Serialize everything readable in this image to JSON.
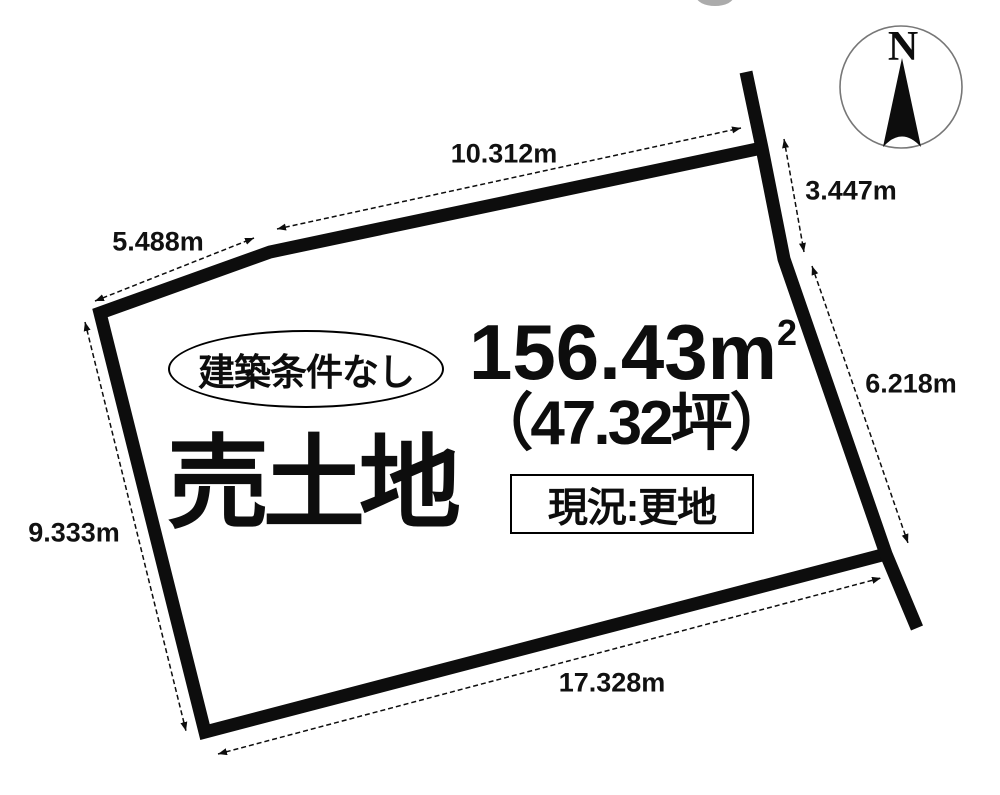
{
  "diagram": {
    "title": "売土地",
    "condition_badge": "建築条件なし",
    "area_m2": "156.43m",
    "area_m2_sup": "2",
    "area_tsubo": "（47.32坪）",
    "status_label": "現況:更地",
    "compass_north": "N"
  },
  "dimensions": {
    "top": {
      "label": "10.312m"
    },
    "top_left": {
      "label": "5.488m"
    },
    "right_upper": {
      "label": "3.447m"
    },
    "right_lower": {
      "label": "6.218m"
    },
    "left": {
      "label": "9.333m"
    },
    "bottom": {
      "label": "17.328m"
    }
  },
  "colors": {
    "line": "#0d0d0d",
    "background": "#ffffff",
    "compass_ring": "#777777"
  }
}
